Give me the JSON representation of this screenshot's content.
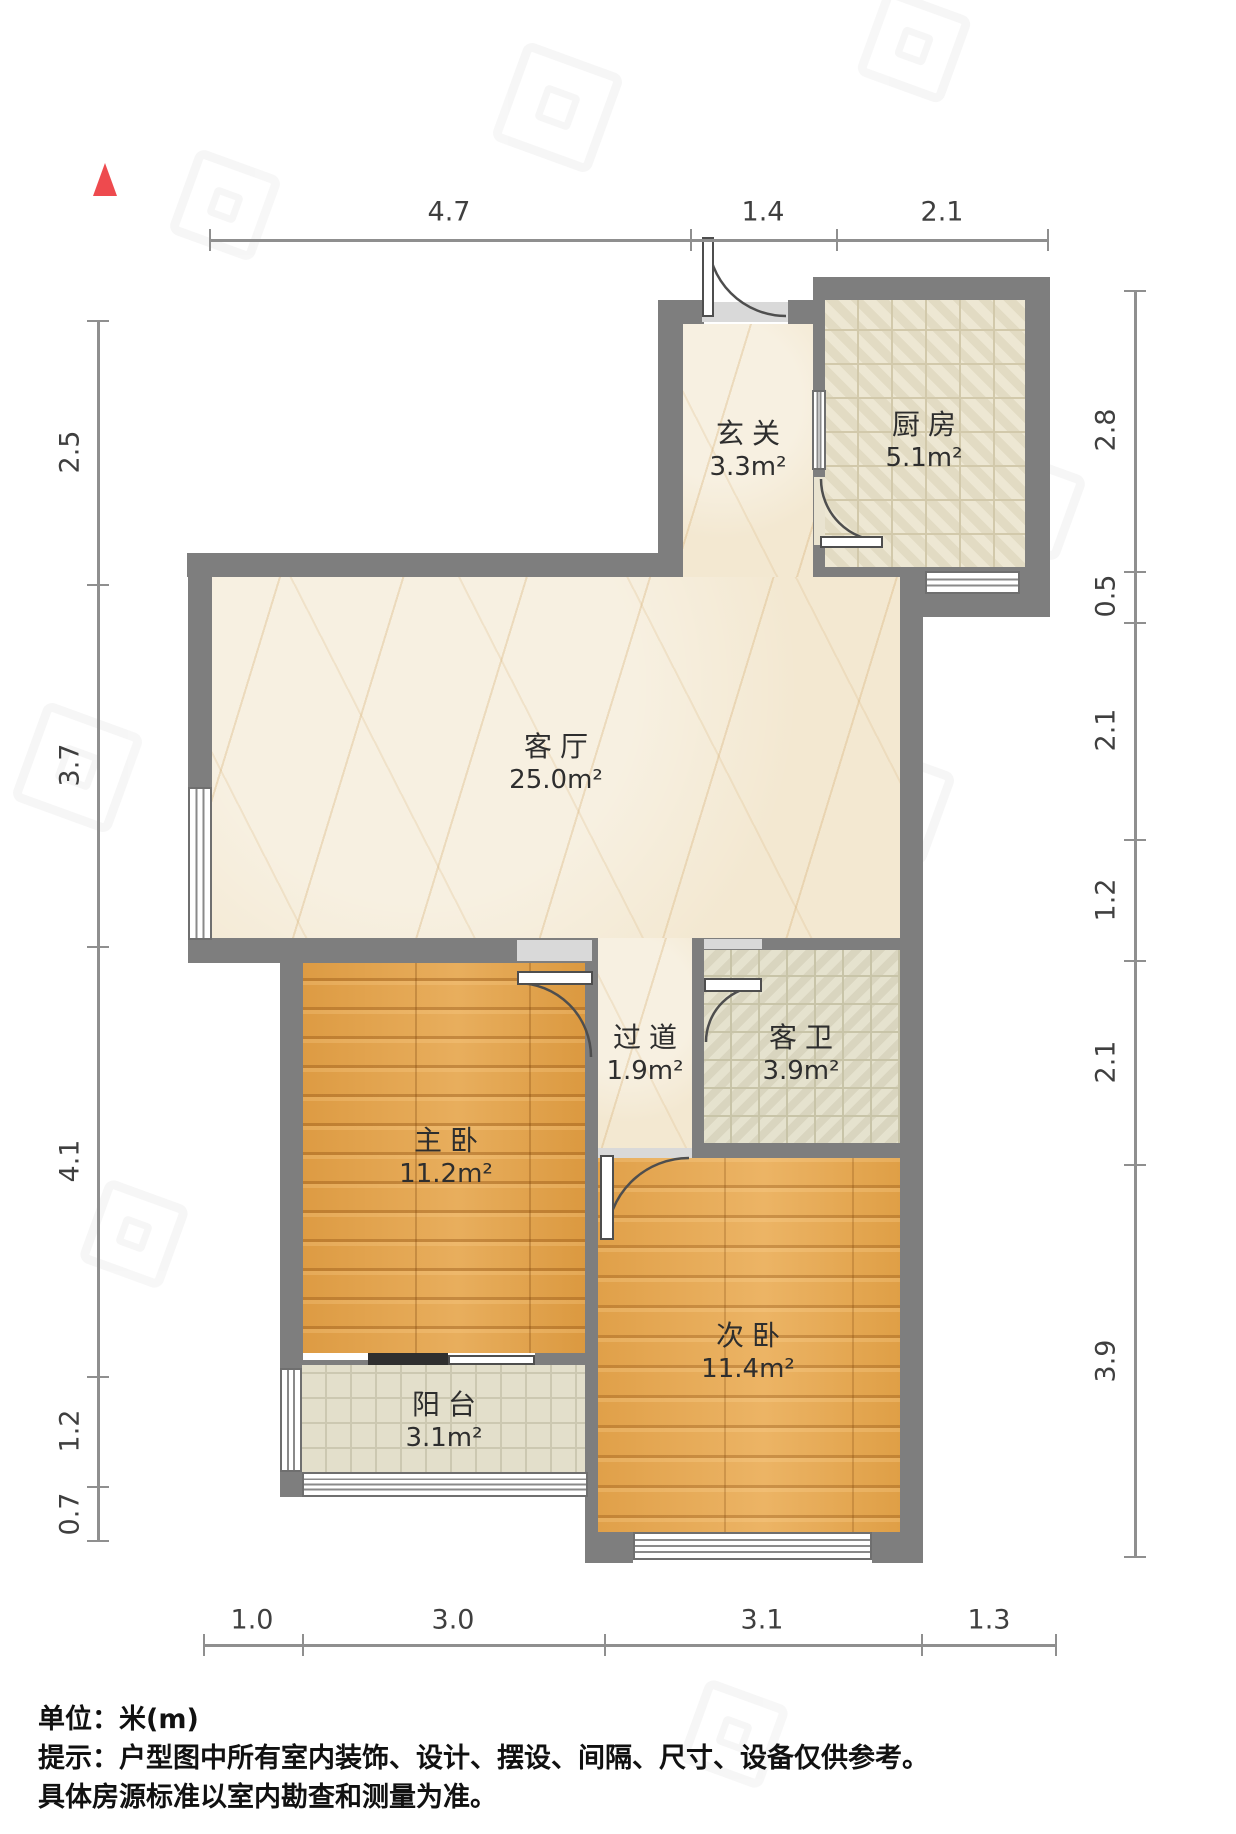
{
  "plan": {
    "title_type": "residential-floorplan",
    "wall_color": "#7e7e7e",
    "north_arrow_color": "#ee4a4e"
  },
  "rooms": [
    {
      "id": "entry",
      "name": "玄关",
      "area": "3.3m²"
    },
    {
      "id": "kitchen",
      "name": "厨房",
      "area": "5.1m²"
    },
    {
      "id": "living",
      "name": "客厅",
      "area": "25.0m²"
    },
    {
      "id": "hallway",
      "name": "过道",
      "area": "1.9m²"
    },
    {
      "id": "bath",
      "name": "客卫",
      "area": "3.9m²"
    },
    {
      "id": "master",
      "name": "主卧",
      "area": "11.2m²"
    },
    {
      "id": "second",
      "name": "次卧",
      "area": "11.4m²"
    },
    {
      "id": "balcony",
      "name": "阳台",
      "area": "3.1m²"
    }
  ],
  "dimensions": {
    "top": [
      "4.7",
      "1.4",
      "2.1"
    ],
    "bottom": [
      "1.0",
      "3.0",
      "3.1",
      "1.3"
    ],
    "left": [
      "2.5",
      "3.7",
      "4.1",
      "1.2",
      "0.7"
    ],
    "right": [
      "2.8",
      "0.5",
      "2.1",
      "1.2",
      "2.1",
      "3.9"
    ]
  },
  "footer": {
    "unit_line": "单位：米(m)",
    "note_line1": "提示：户型图中所有室内装饰、设计、摆设、间隔、尺寸、设备仅供参考。",
    "note_line2": "具体房源标准以室内勘查和测量为准。"
  }
}
